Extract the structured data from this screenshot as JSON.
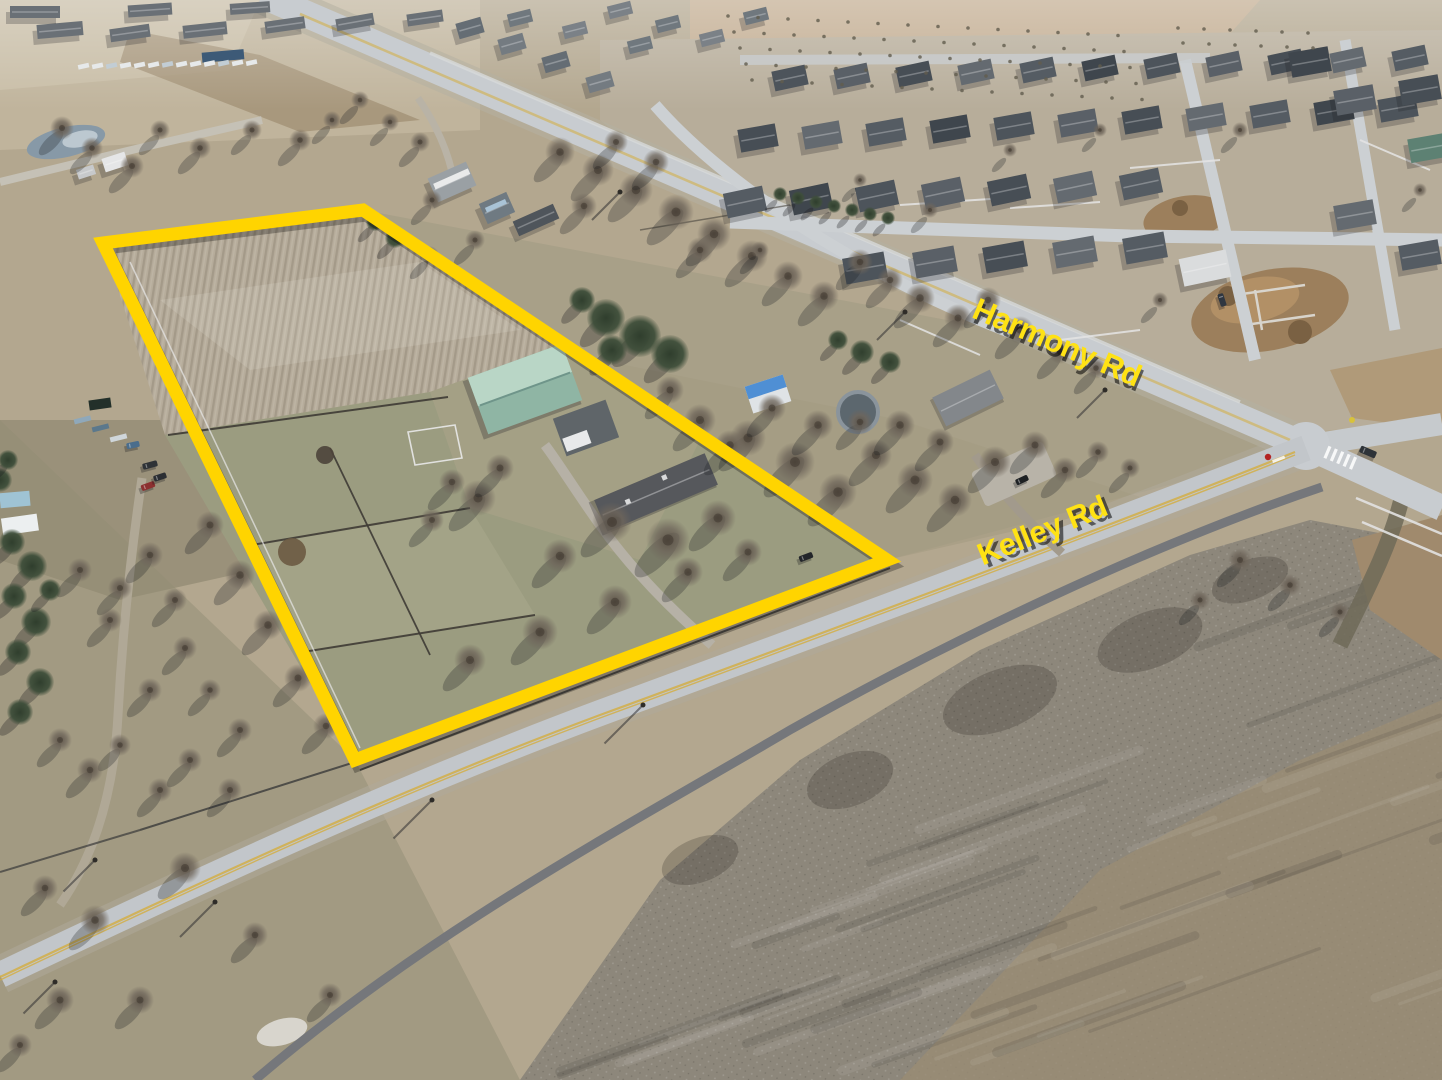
{
  "photo": {
    "type": "aerial-drone-real-estate-photo",
    "scene": "Aerial view of a rural acreage outlined in yellow at the corner of Harmony Rd and Kelley Rd, with a teal-roof barn, ranch house, plowed field and paddocks, bordered by a suburban subdivision, farm fields and open brush land"
  },
  "annotations": {
    "property_boundary": {
      "color": "#FFD400",
      "stroke_width": 13,
      "points_str": "103,243 363,210 887,560 355,760"
    },
    "road_labels": [
      {
        "text": "Harmony Rd",
        "color": "#FFE214",
        "x": 1053,
        "y": 352,
        "rotation": 23
      },
      {
        "text": "Kelley Rd",
        "color": "#FFE214",
        "x": 1046,
        "y": 540,
        "rotation": -22
      }
    ]
  },
  "palette": {
    "boundary_yellow": "#FFD400",
    "label_yellow": "#FFE214",
    "road_gray": "#C8CCD0",
    "bike_path_gray": "#75777B",
    "plow_field_tan": "#B6AC9B",
    "paddock_grass": "#9B9C80",
    "east_lawn": "#A8A088",
    "brush_gray": "#8D877B",
    "brush_brown": "#9A8C74",
    "barn_roof_teal": "#8FB5A4",
    "house_roof_gray": "#56585C",
    "center_line_yellow": "#D3AD3E"
  }
}
